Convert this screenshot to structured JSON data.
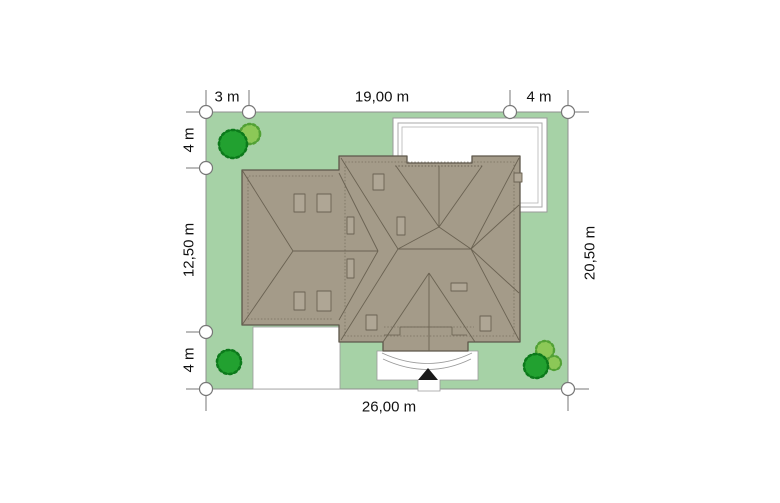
{
  "plan_title": "house site plan (plot plan with roof view)",
  "dimensions": {
    "top_left_setback": "3 m",
    "top_house_width": "19,00 m",
    "top_right_setback": "4 m",
    "left_top_setback": "4 m",
    "left_house_depth": "12,50 m",
    "left_bottom_setback": "4 m",
    "right_lot_depth": "20,50 m",
    "bottom_lot_width": "26,00 m"
  },
  "colors": {
    "lot": "#a6d2a6",
    "paving": "#ffffff",
    "roof": "#a49b89",
    "roof_line": "#6a6252",
    "roof_outline": "#5e574b",
    "chimney": "#afa695",
    "tree_dark": "#22a130",
    "tree_dark_edge": "#0c7a1b",
    "tree_light": "#8cc857",
    "tree_light_edge": "#52a135",
    "boundary_gray": "#8f8f8f",
    "dimension_gray": "#777777",
    "entrance_marker": "#1a1a1a"
  },
  "features": {
    "trees": [
      {
        "corner": "top-left",
        "count": 2
      },
      {
        "corner": "bottom-left",
        "count": 1
      },
      {
        "corner": "bottom-right",
        "count": 3
      }
    ],
    "terrace": "white paved terrace, top-right of house",
    "driveway": "white driveway, bottom-left",
    "entrance": "walkway with curved steps and black arrow marker, bottom-center"
  }
}
